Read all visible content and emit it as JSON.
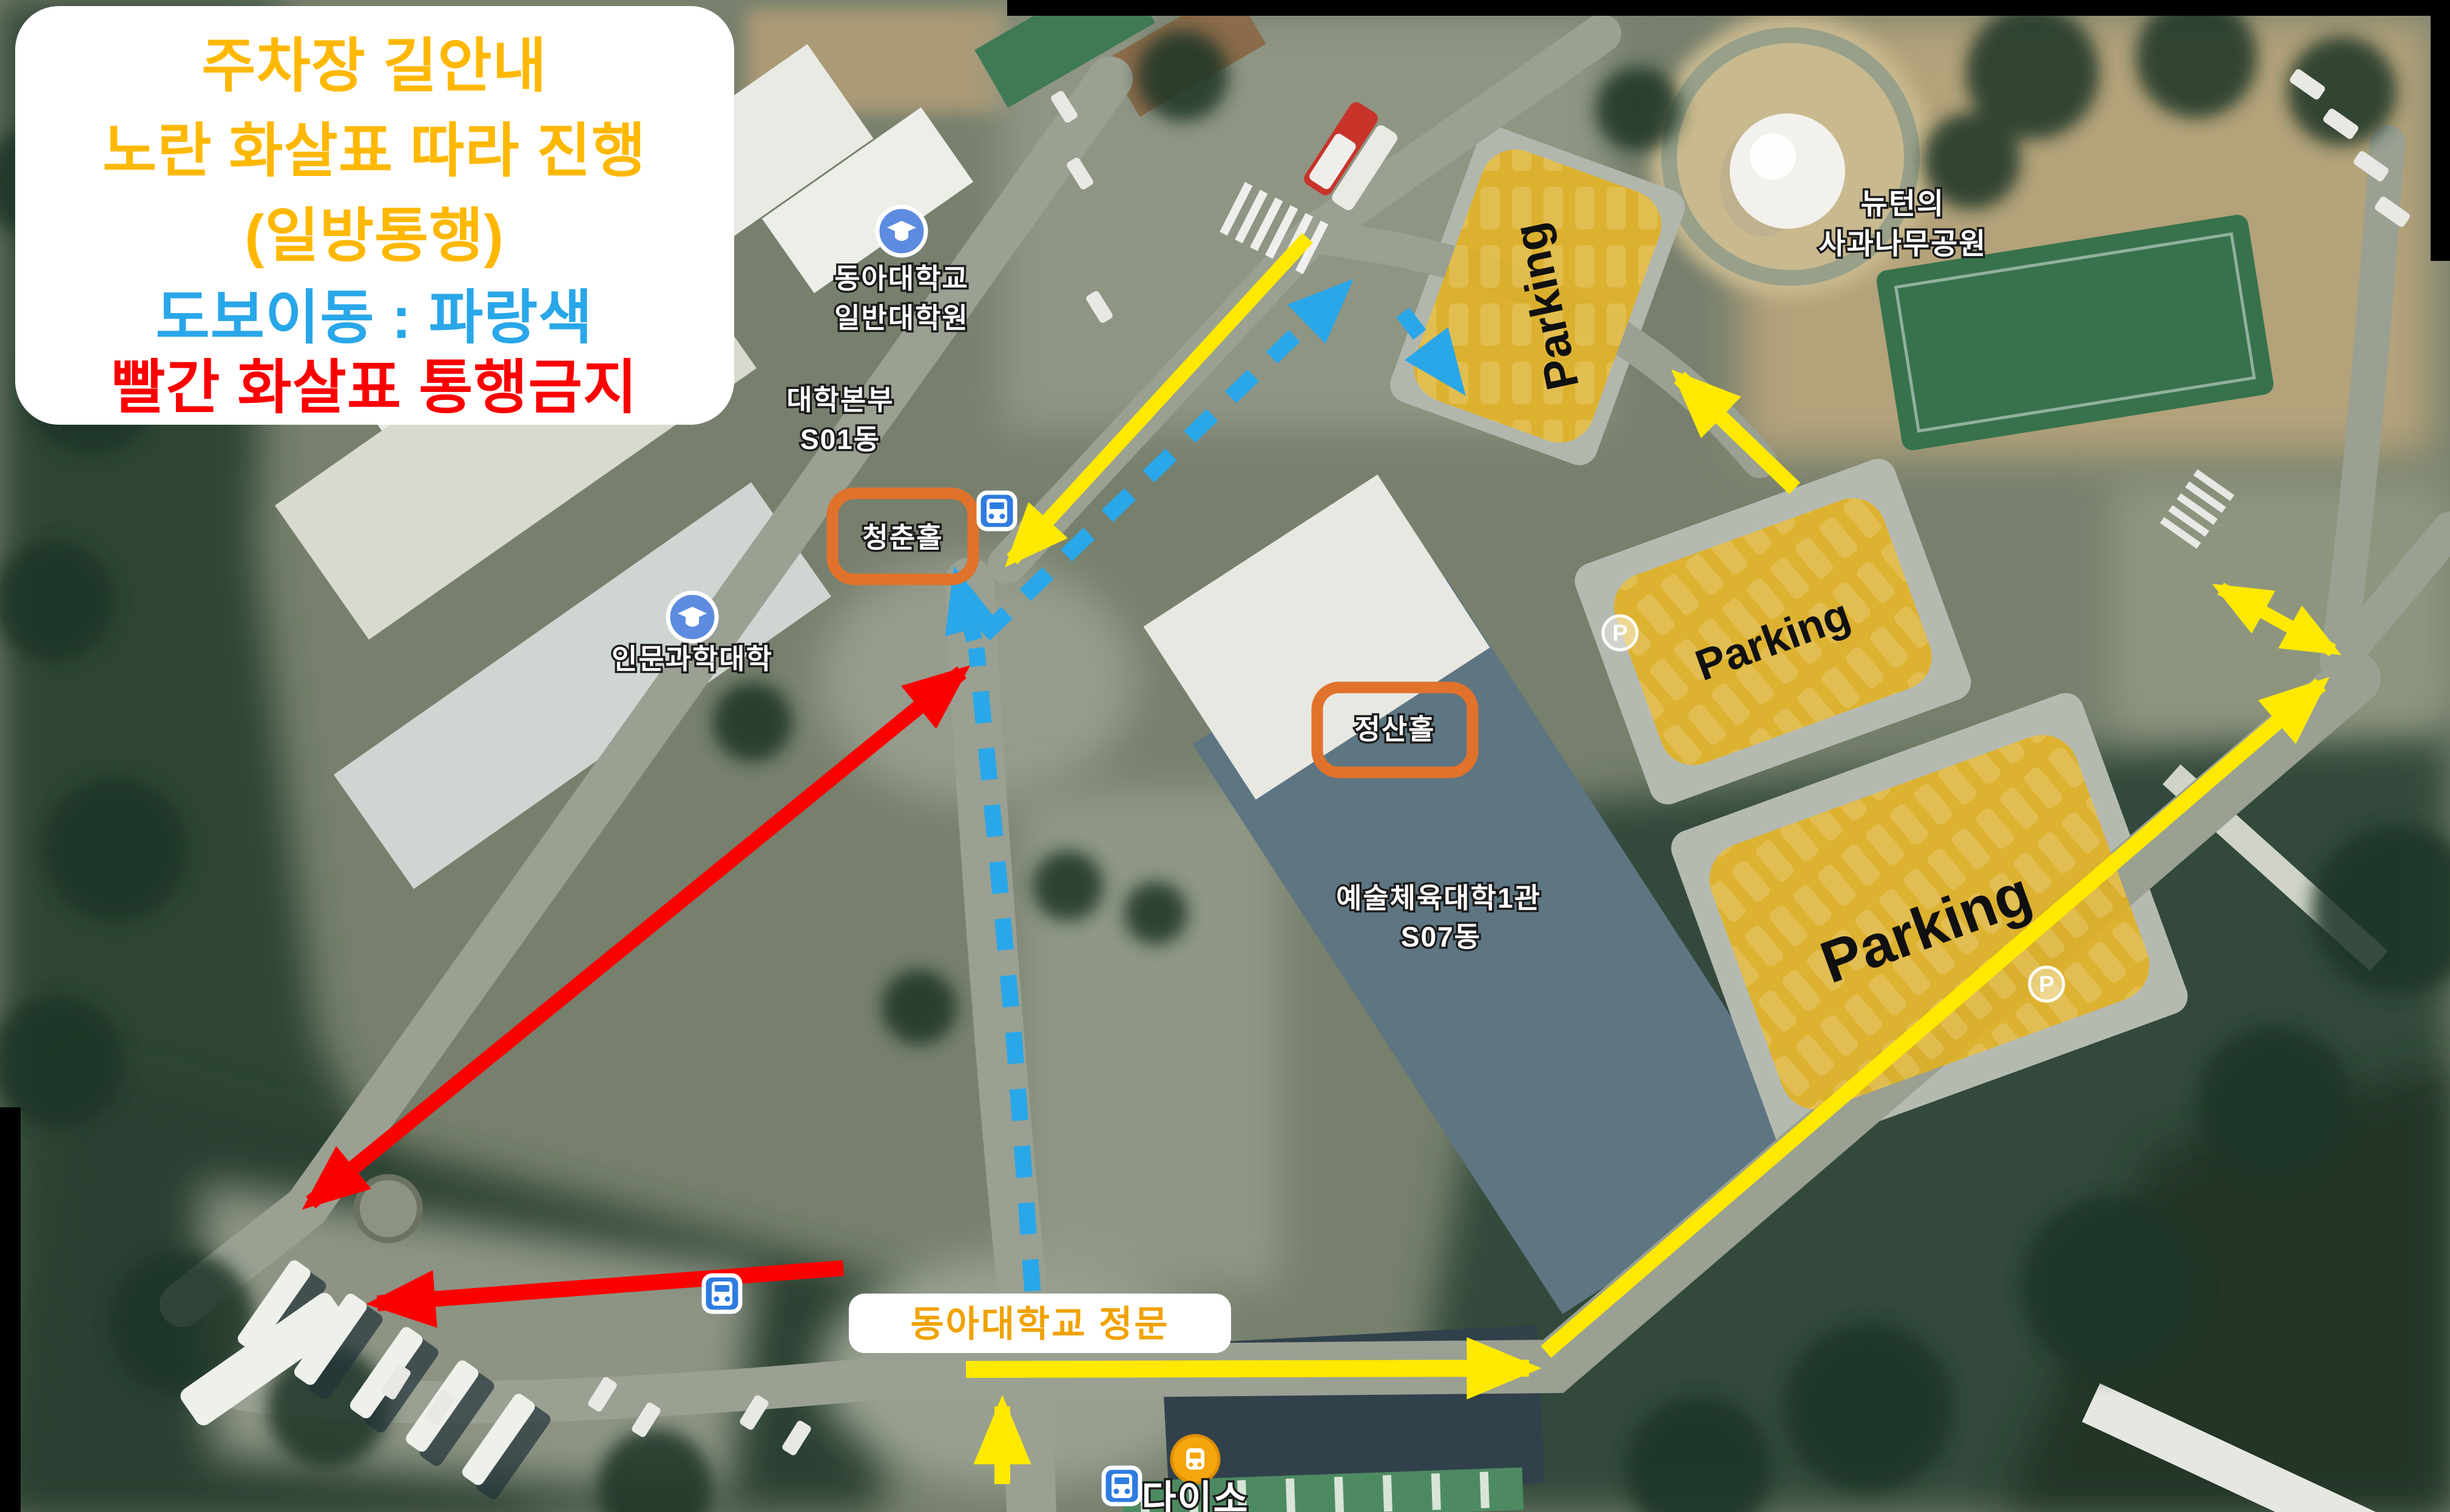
{
  "legend": {
    "line1": {
      "text": "주차장 길안내",
      "color": "#FFB800"
    },
    "line2": {
      "text": "노란 화살표 따라 진행",
      "color": "#FFB800"
    },
    "line3": {
      "text": "(일방통행)",
      "color": "#FFB800"
    },
    "line4": {
      "text": "도보이동 : 파랑색",
      "color": "#29A7E9"
    },
    "line5": {
      "text": "빨간 화살표 통행금지",
      "color": "#FB0000"
    }
  },
  "labels": {
    "grad_school_line1": "동아대학교",
    "grad_school_line2": "일반대학원",
    "admin_line1": "대학본부",
    "admin_line2": "S01동",
    "humanities": "인문과학대학",
    "chungchon_hall": "청춘홀",
    "jeongsan_hall": "정산홀",
    "arts_pe_line1": "예술체육대학1관",
    "arts_pe_line2": "S07동",
    "newton_line1": "뉴턴의",
    "newton_line2": "사과나무공원",
    "daiso": "다이소",
    "main_gate": "동아대학교 정문"
  },
  "parking": {
    "area1_label": "Parking",
    "area2_label": "Parking",
    "area3_label": "Parking",
    "marker_letter": "P"
  },
  "route_colors": {
    "driving_one_way": "#FFE900",
    "walking": "#29A7E9",
    "prohibited": "#FB0000",
    "parking_area_fill": "#E3B01F",
    "hall_outline": "#E0722C",
    "gate_label_text": "#F0A202"
  },
  "icons": {
    "bus_stop": "bus-icon",
    "university": "graduation-cap-icon",
    "store_marker": "store-bus-icon",
    "parking_marker": "parking-p-icon"
  }
}
